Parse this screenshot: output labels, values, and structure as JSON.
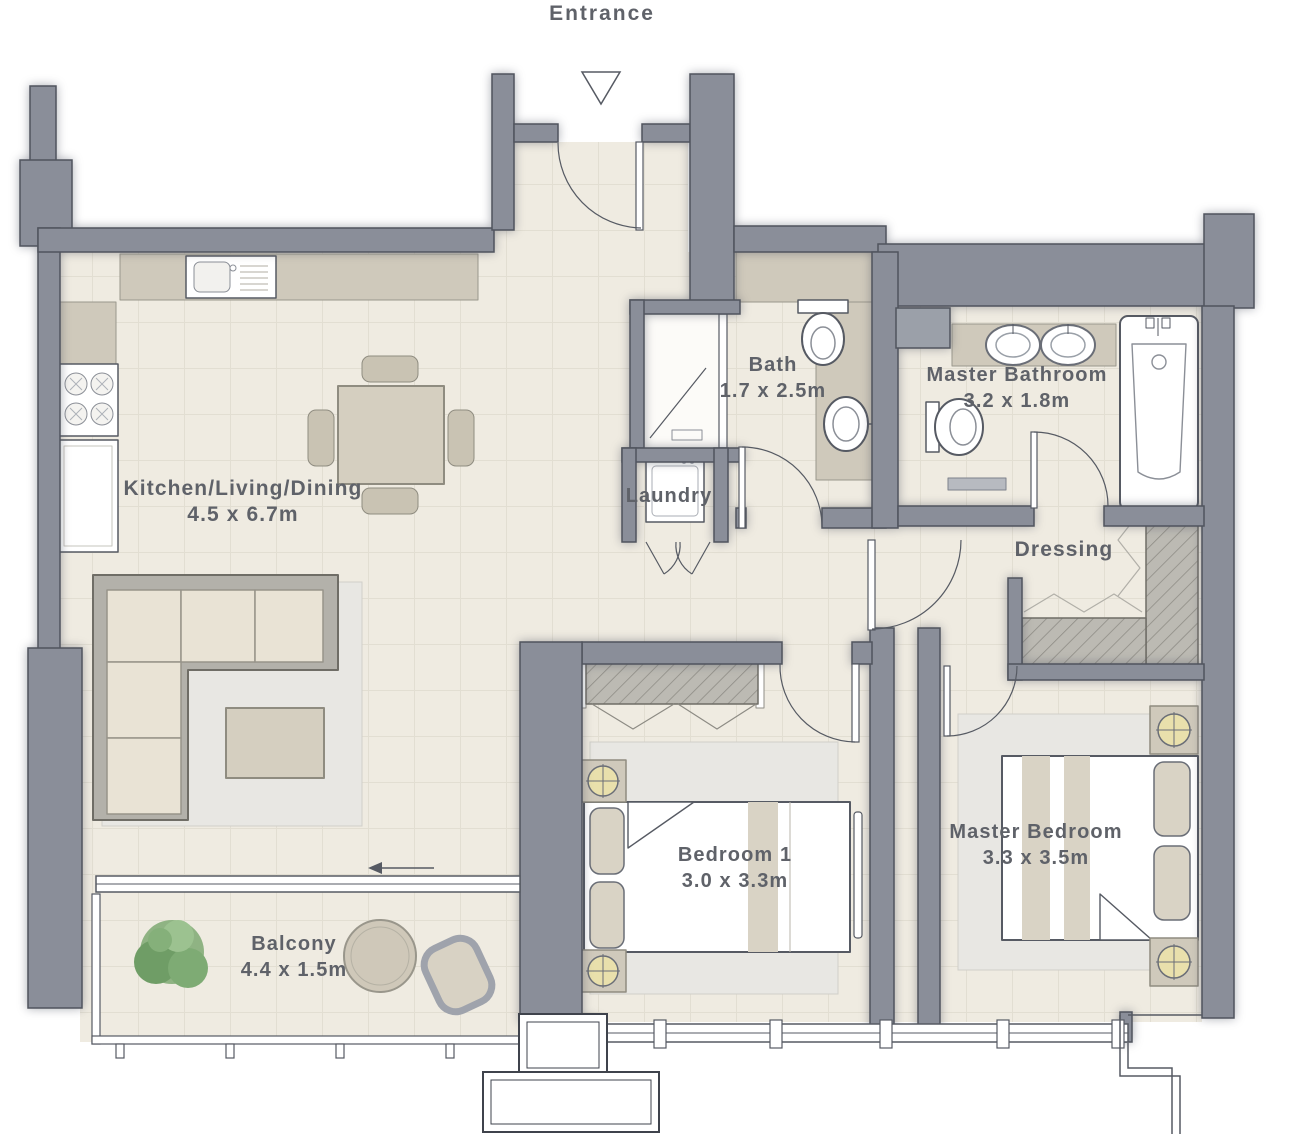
{
  "entrance": {
    "label": "Entrance"
  },
  "rooms": [
    {
      "id": "kitchen-living-dining",
      "name": "Kitchen/Living/Dining",
      "dims": "4.5 x 6.7m"
    },
    {
      "id": "bath",
      "name": "Bath",
      "dims": "1.7 x 2.5m"
    },
    {
      "id": "laundry",
      "name": "Laundry",
      "dims": ""
    },
    {
      "id": "master-bathroom",
      "name": "Master Bathroom",
      "dims": "3.2 x 1.8m"
    },
    {
      "id": "dressing",
      "name": "Dressing",
      "dims": ""
    },
    {
      "id": "bedroom-1",
      "name": "Bedroom 1",
      "dims": "3.0 x 3.3m"
    },
    {
      "id": "master-bedroom",
      "name": "Master Bedroom",
      "dims": "3.3 x 3.5m"
    },
    {
      "id": "balcony",
      "name": "Balcony",
      "dims": "4.4 x 1.5m"
    }
  ],
  "colors": {
    "wall": "#8a8e99",
    "wall_outline": "#50545e",
    "floor": "#efebe1",
    "counter": "#cfc9bb",
    "cushion": "#e9e3d5",
    "rug": "#e8e7e3",
    "label_text": "#5f6269",
    "plant": "#7fa878",
    "fixture_white": "#ffffff"
  }
}
